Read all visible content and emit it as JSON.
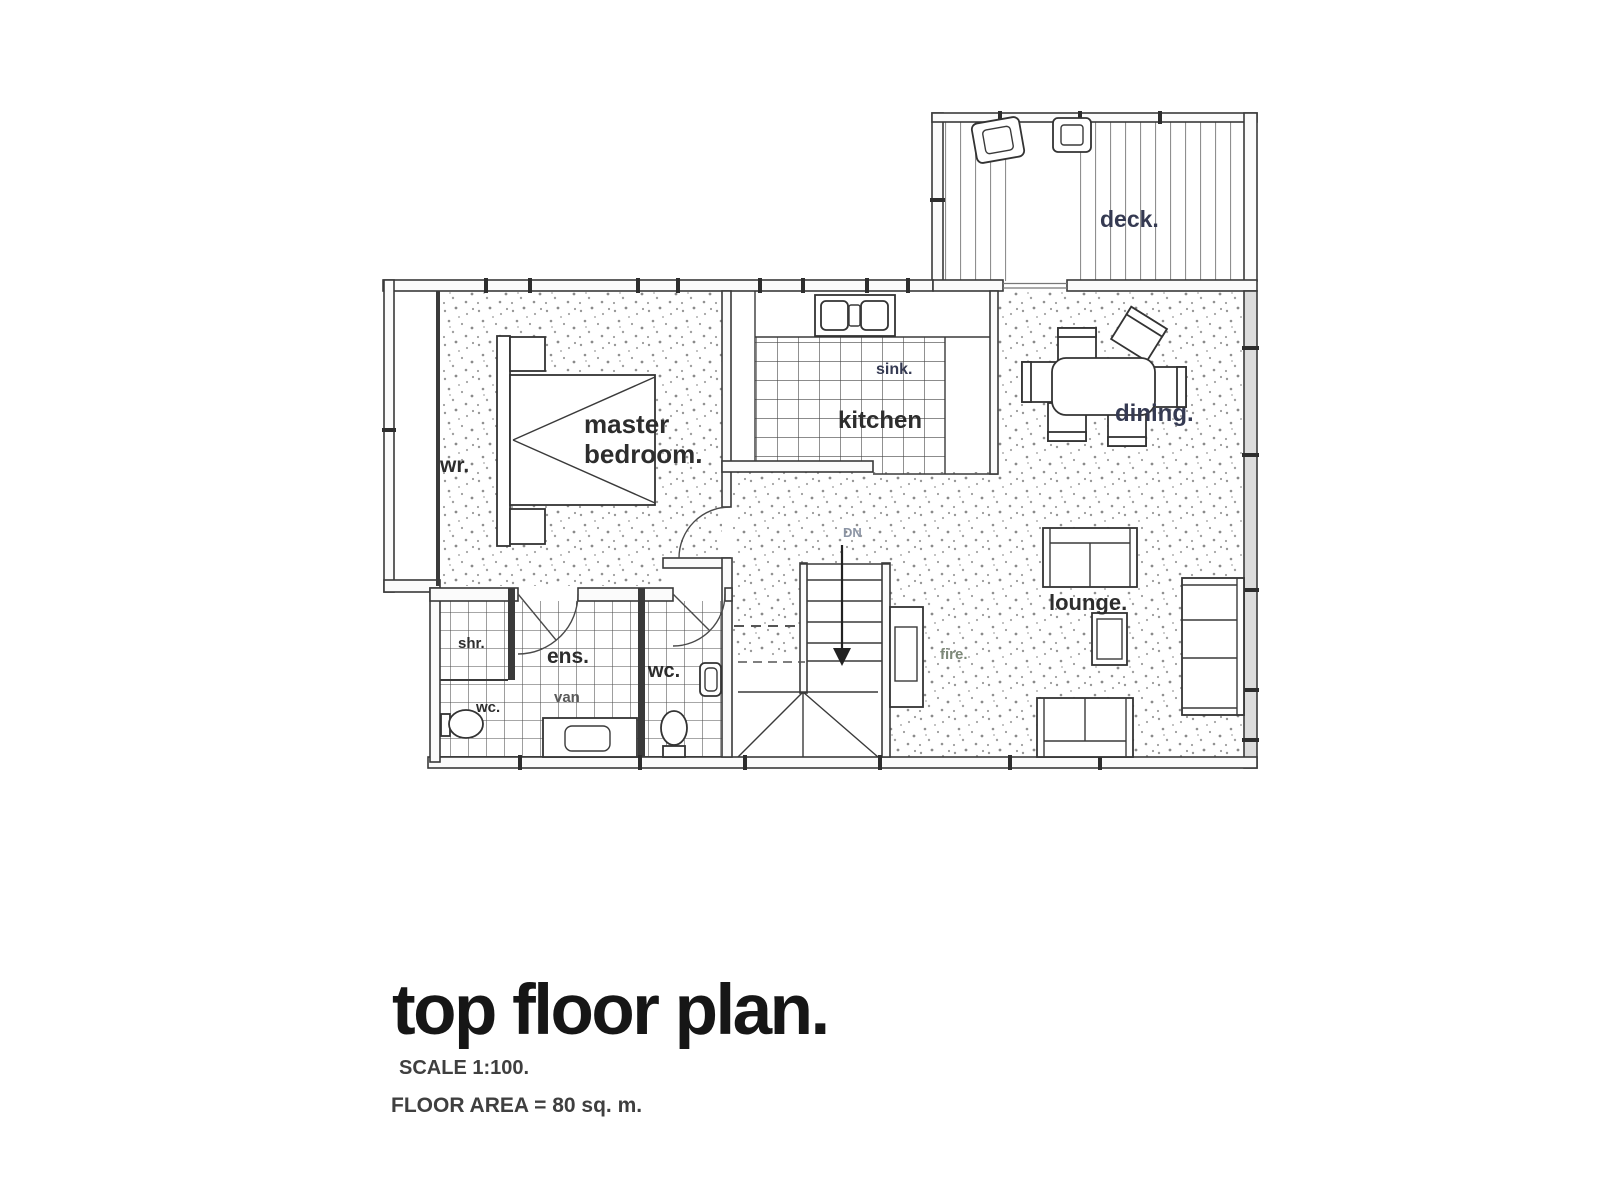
{
  "floor_plan": {
    "rooms": {
      "deck": "deck.",
      "master_bedroom_line1": "master",
      "master_bedroom_line2": "bedroom.",
      "wardrobe": "wr.",
      "kitchen": "kitchen",
      "sink": "sink.",
      "dining": "dining.",
      "lounge": "lounge.",
      "fireplace": "fire.",
      "stairs_direction": "DN",
      "shower": "shr.",
      "ensuite": "ens.",
      "wc_ensuite": "wc.",
      "vanity": "van",
      "wc_separate": "wc."
    },
    "colors": {
      "wall_line": "#3a3a3a",
      "label_dark": "#2d2d2d",
      "label_navy": "#353a52",
      "label_fire": "#7d8878",
      "label_dn": "#8b94a4",
      "stipple_dot": "#979797",
      "glazed_wall_fill": "#dcdcdc"
    }
  },
  "title_block": {
    "title": "top floor plan.",
    "scale": "SCALE 1:100.",
    "floor_area": "FLOOR AREA = 80 sq. m."
  }
}
